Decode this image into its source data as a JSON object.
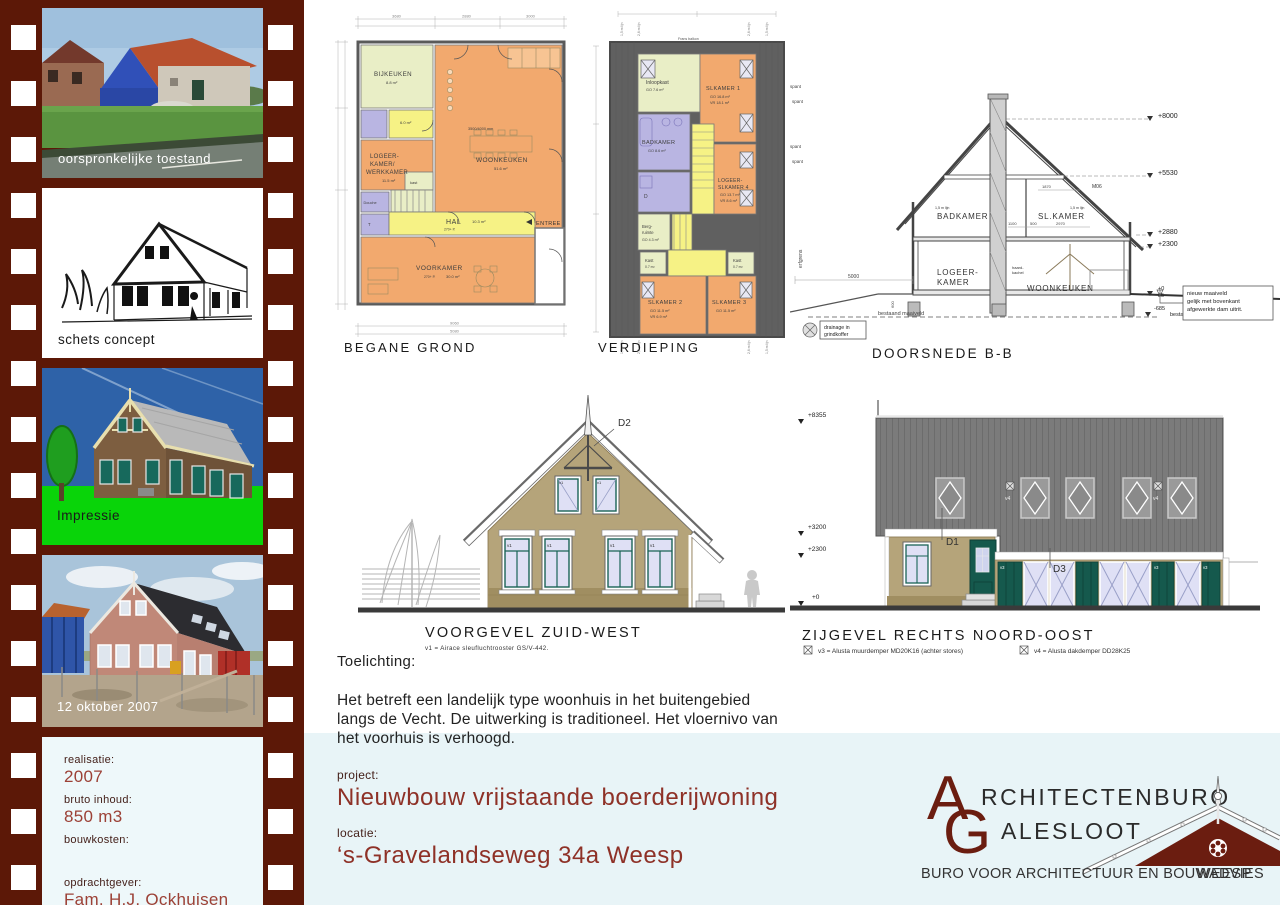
{
  "filmstrip": {
    "frame1_label": "oorspronkelijke toestand",
    "frame2_label": "schets concept",
    "frame3_label": "Impressie",
    "frame4_label": "12 oktober 2007",
    "info": {
      "realisatie_label": "realisatie:",
      "realisatie": "2007",
      "inhoud_label": "bruto inhoud:",
      "inhoud": "850 m3",
      "kosten_label": "bouwkosten:",
      "opdrachtgever_label": "opdrachtgever:",
      "opdrachtgever": "Fam. H.J. Ockhuisen",
      "constructie_label": "constructie:",
      "constructie": "J. IJskes Dalfsen"
    }
  },
  "begane_grond": {
    "title": "BEGANE GROND",
    "bijkeuken": "BIJKEUKEN",
    "bijkeuken_area": "8.8 m²",
    "woonkeuken": "WOONKEUKEN",
    "woonkeuken_area": "51.6 m²",
    "woonkeuken_note": "3500/4000 mm",
    "logeer_l1": "LOGEER-",
    "logeer_l2": "KAMER/",
    "logeer_l3": "WERKKAMER",
    "logeer_area": "11.5 m²",
    "hal": "HAL",
    "hal_area": "10.3 m²",
    "hal_note": "270+ P.",
    "voorkamer": "VOORKAMER",
    "voorkamer_note": "270+ P.",
    "voorkamer_area": "30.0 m²",
    "douche": "Douche",
    "wc": "T",
    "kast": "kast",
    "kastje_area": "6.0 m²",
    "entree": "ENTREE",
    "dim_top_1": "3680",
    "dim_top_2": "2880",
    "dim_top_3": "3000",
    "dim_bottom_1": "9060",
    "dim_bottom_2": "5080"
  },
  "verdieping": {
    "title": "VERDIEPING",
    "frans_balkon": "Frans balkon",
    "lijn15": "1,5 m lijn",
    "lijn26": "2,6 m lijn",
    "inloopkast": "Inloopkast",
    "inloopkast_area": "GO 7.6 m²",
    "slkamer1": "SLKAMER 1",
    "slkamer1_go": "GO 16.8 m²",
    "slkamer1_vr": "VR 18.1 m²",
    "badkamer": "BADKAMER",
    "badkamer_area": "GO 8.6 m²",
    "d_cell": "D",
    "logeer_l1": "LOGEER-",
    "logeer_l2": "SLKAMER 4",
    "logeer_go": "GO 13.7 m²",
    "logeer_vr": "VR 8.6 m²",
    "berg_l1": "Berg-",
    "berg_l2": "ruimte",
    "berg_area": "GO 4.3 m²",
    "kast1": "Kast",
    "kast1_area": "0.7 m²",
    "kast2": "Kast",
    "kast2_area": "0.7 m²",
    "slkamer2": "SLKAMER 2",
    "slkamer2_go": "GO 11.5 m²",
    "slkamer2_vr": "VR 6.9 m²",
    "slkamer3": "SLKAMER 3",
    "slkamer3_go": "GO 11.5 m²",
    "spant1": "spant",
    "spant2": "spant"
  },
  "doorsnede": {
    "title": "DOORSNEDE B-B",
    "badkamer": "BADKAMER",
    "slkamer": "SL.KAMER",
    "logeer_l1": "LOGEER-",
    "logeer_l2": "KAMER",
    "woonkeuken": "WOONKEUKEN",
    "haard_l1": "haard-",
    "haard_l2": "kachel",
    "m06": "M06",
    "lijn_left": "1,5 m lijn",
    "lijn_right": "1,5 m lijn",
    "lvl_8000": "+8000",
    "lvl_5530": "+5530",
    "lvl_2880": "+2880",
    "lvl_2300": "+2300",
    "lvl_0": "+0",
    "lvl_85": "85",
    "lvl_685": "-685",
    "bestaand_r": "bestaand maaiveld",
    "bestaand_b": "bestaand maaiveld",
    "note_l1": "nieuw maaiveld",
    "note_l2": "gelijk met bovenkant",
    "note_l3": "afgewerkte dam uitrit.",
    "drain_l1": "drainage in",
    "drain_l2": "grindkoffer",
    "erfgrens": "erfgrens",
    "spant1": "spant",
    "spant2": "spant",
    "dim_5000": "5000",
    "dim_600": "600",
    "dim_1870": "1870",
    "dim_1100": "1100",
    "dim_500": "500",
    "dim_2970": "2970"
  },
  "voorgevel": {
    "title": "VOORGEVEL ZUID-WEST",
    "note": "v1 = Airace sleufluchtrooster GS/V-442.",
    "d2": "D2",
    "v1": "v1"
  },
  "zijgevel": {
    "title": "ZIJGEVEL RECHTS   NOORD-OOST",
    "d1": "D1",
    "d3": "D3",
    "v3": "v3",
    "v4": "v4",
    "lvl_8355": "+8355",
    "lvl_3200": "+3200",
    "lvl_2300": "+2300",
    "lvl_0": "+0",
    "legend_v3": "v3 = Alusta muurdemper MD20K16 (achter stores)",
    "legend_v4": "v4 = Alusta dakdemper DD28K25"
  },
  "toelichting": {
    "heading": "Toelichting:",
    "body": "Het betreft een landelijk type woonhuis in het buitengebied langs de Vecht. De uitwerking is traditioneel. Het vloernivo van het voorhuis is verhoogd."
  },
  "project": {
    "project_label": "project:",
    "project": "Nieuwbouw vrijstaande boerderijwoning",
    "locatie_label": "locatie:",
    "locatie": "‘s-Gravelandseweg 34a Weesp"
  },
  "logo": {
    "a": "A",
    "rest1": "RCHITECTENBURO",
    "g": "G",
    "rest2": "ALESLOOT",
    "subtitle": "BURO VOOR ARCHITECTUUR EN BOUWADVIES",
    "city": "WEESP"
  },
  "colors": {
    "filmstrip": "#5c1807",
    "band": "#e8f4f7",
    "maroon_title": "#8e3127",
    "maroon_value": "#9c4136",
    "logo_maroon": "#6b1d10",
    "plan_orange": "#f2a96e",
    "plan_yellow": "#f6f285",
    "plan_green": "#e9eec6",
    "plan_purple": "#b9b5e2",
    "facade_tan": "#b5a47a",
    "door_teal": "#15594d",
    "roof_gray": "#7b7b7b"
  }
}
